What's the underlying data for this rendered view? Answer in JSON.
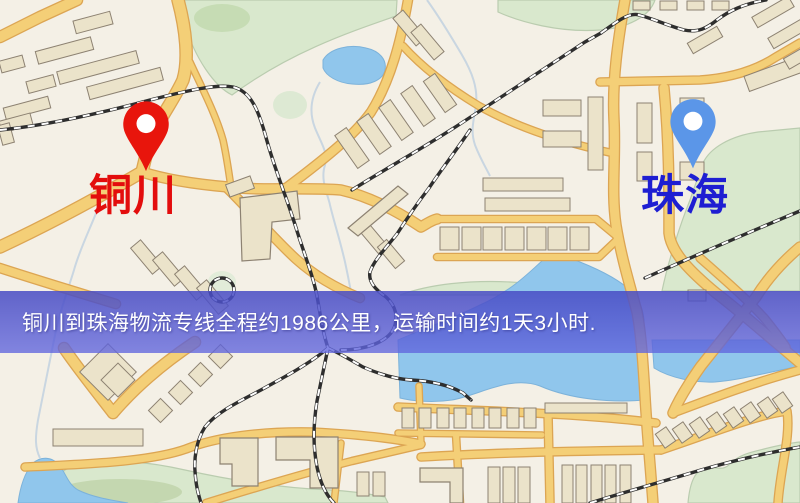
{
  "origin": {
    "name": "铜川"
  },
  "destination": {
    "name": "珠海"
  },
  "route": {
    "distance_km": 1986,
    "duration": "1天3小时"
  },
  "banner": {
    "text": "铜川到珠海物流专线全程约1986公里，运输时间约1天3小时."
  },
  "icons": {
    "origin_pin": "red-map-pin",
    "destination_pin": "blue-map-pin"
  },
  "colors": {
    "origin_pin": "#e8150c",
    "origin_label": "#e30d0d",
    "destination_pin": "#5b96e8",
    "destination_label": "#1e1ed2",
    "banner_bg": "#5a60cc",
    "banner_text": "#ffffff",
    "road_fill": "#f6cf72",
    "road_casing": "#dfa54e",
    "water": "#8ec6ee",
    "park": "#d9e8cc",
    "building": "#ebe3c9",
    "railway": "#2e2e2e",
    "map_bg": "#f4f0e5"
  }
}
